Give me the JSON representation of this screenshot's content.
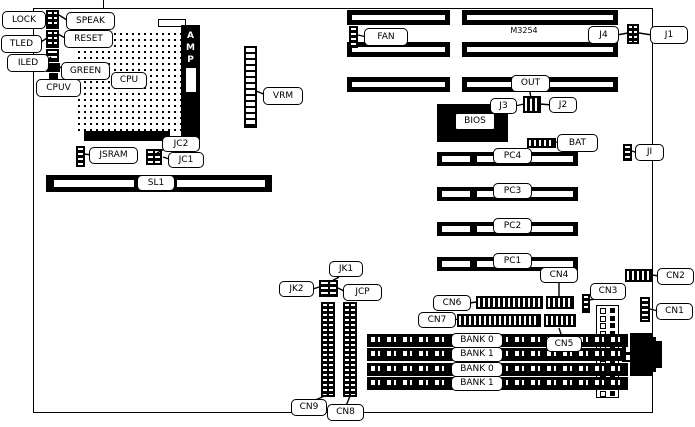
{
  "callouts": {
    "lock": "LOCK",
    "speak": "SPEAK",
    "tled": "TLED",
    "reset": "RESET",
    "iled": "ILED",
    "green": "GREEN",
    "cpuv": "CPUV",
    "cpu": "CPU",
    "amp": "AMP",
    "vrm": "VRM",
    "jsram": "JSRAM",
    "jc2": "JC2",
    "jc1": "JC1",
    "sl1": "SL1",
    "fan": "FAN",
    "j4": "J4",
    "j1": "J1",
    "out": "OUT",
    "j3": "J3",
    "j2": "J2",
    "bios": "BIOS",
    "bat": "BAT",
    "ji": "JI",
    "pc4": "PC4",
    "pc3": "PC3",
    "pc2": "PC2",
    "pc1": "PC1",
    "jk1": "JK1",
    "jk2": "JK2",
    "jcp": "JCP",
    "cn1": "CN1",
    "cn2": "CN2",
    "cn3": "CN3",
    "cn4": "CN4",
    "cn5": "CN5",
    "cn6": "CN6",
    "cn7": "CN7",
    "cn8": "CN8",
    "cn9": "CN9"
  },
  "markings": {
    "board_model": "M3254"
  },
  "memory_banks": [
    "BANK 0",
    "BANK 1",
    "BANK 0",
    "BANK 1"
  ],
  "colors": {
    "background": "#ffffff",
    "ink": "#000000"
  }
}
